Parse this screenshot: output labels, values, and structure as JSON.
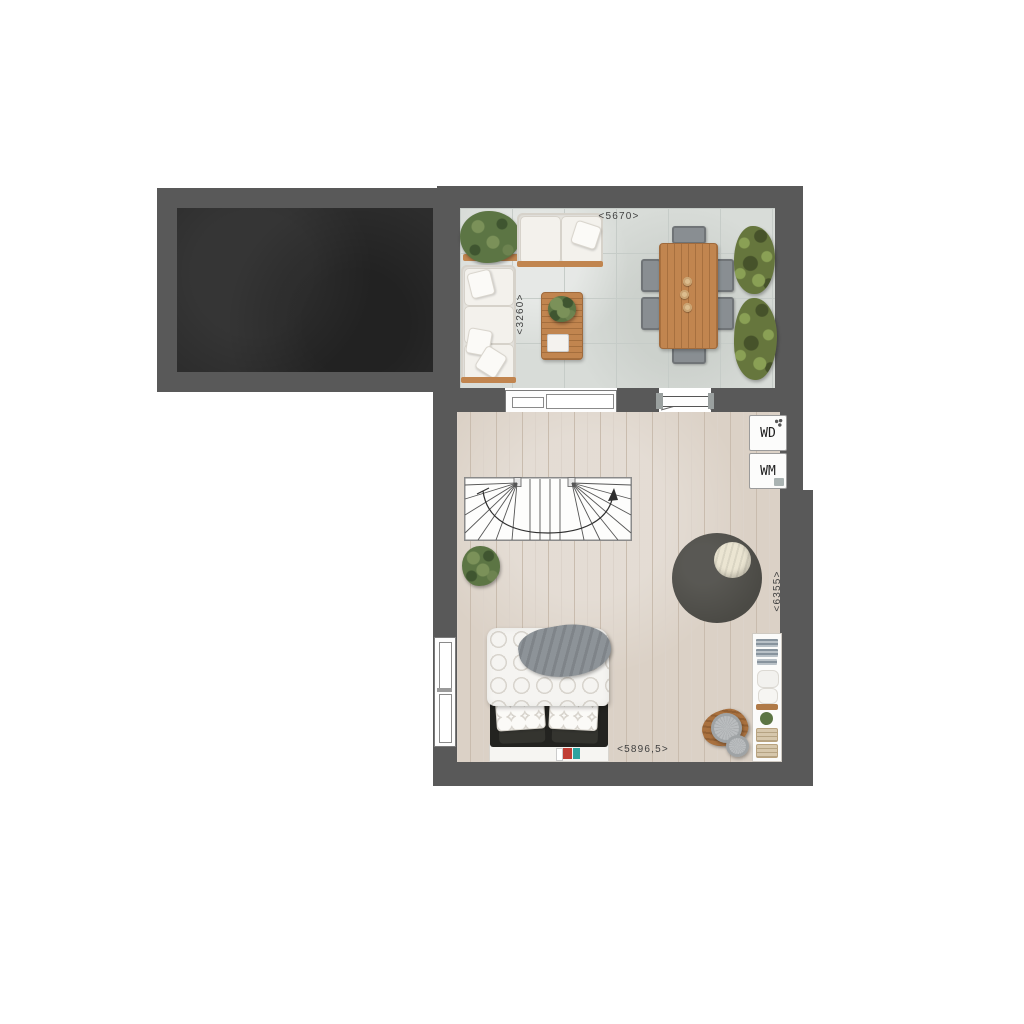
{
  "plan": {
    "dimensions": {
      "terrace_width": {
        "label": "<5670>"
      },
      "terrace_depth": {
        "label": "<3260>"
      },
      "studio_depth": {
        "label": "<6355>"
      },
      "studio_width": {
        "label": "<5896,5>"
      }
    },
    "appliances": {
      "dryer": {
        "label": "WD"
      },
      "washer": {
        "label": "WM"
      }
    },
    "colors": {
      "wall": "#595959",
      "garage_floor": "#2d2d2d",
      "tile": "#d8dcd8",
      "tile_line": "#c6ccc8",
      "wood": "#dbd1c6",
      "wood_line": "#c9bcae",
      "wood_furniture": "#c1854f",
      "wood_dark": "#a06a3c",
      "sofa": "#eae8e2",
      "cushion_shadow": "#d6d2ca",
      "chair": "#898e92",
      "hedge": "#66763d",
      "hedge_light": "#8aa055",
      "hedge_dark": "#46522a",
      "plant": "#5c7544",
      "rug": "#4b4a45",
      "beanbag": "#ebe5d2",
      "headboard": "#232320",
      "blanket": "#8d9398",
      "book_red": "#c13f36",
      "book_teal": "#2fa3a0",
      "basket": "#d6c7ac",
      "text": "#3f3f3f",
      "window_frame": "#7a7a7a",
      "appliance_border": "#9b9b9b"
    }
  }
}
